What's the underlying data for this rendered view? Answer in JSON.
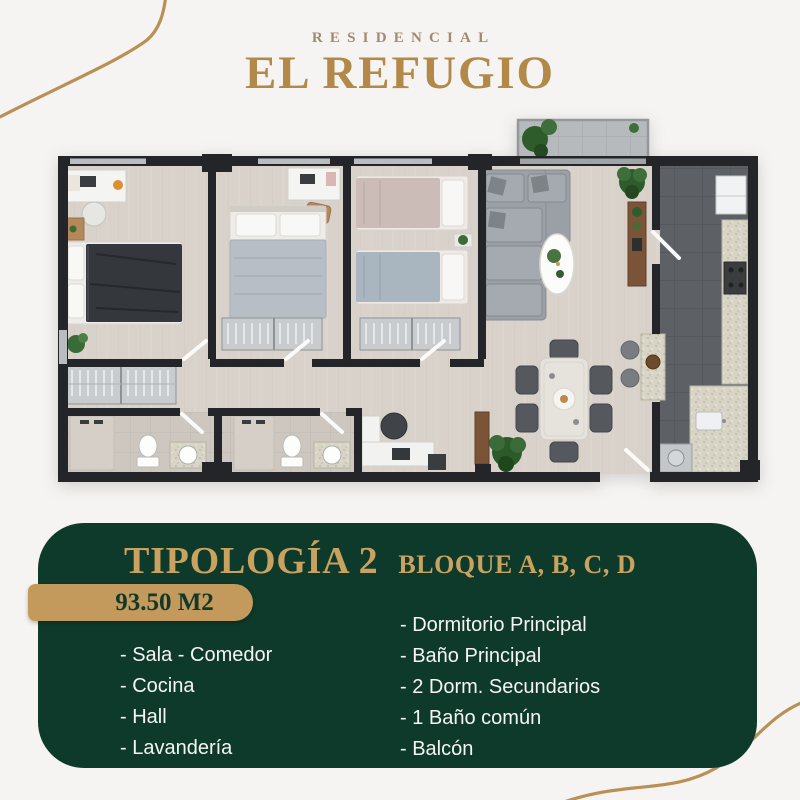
{
  "page": {
    "background": "#f5f4f2",
    "decor_line_color": "#b99055"
  },
  "logo": {
    "subtitle": "RESIDENCIAL",
    "title": "EL REFUGIO",
    "subtitle_color": "#a18b6e",
    "title_color": "#b3894a"
  },
  "floor_plan": {
    "wall_color": "#232528",
    "wood_floor_color": "#d9d2ca",
    "kitchen_tile_color": "#5d6165",
    "bathroom_tile_color": "#cdc7c0",
    "balcony_tile_color": "#b6babc",
    "sofa_color": "#9aa0a5",
    "plant_color": "#2e5c2b",
    "wood_accent_color": "#b5885c"
  },
  "card": {
    "background": "#0e3a2b",
    "title": "TIPOLOGÍA 2",
    "subtitle": "BLOQUE A, B, C, D",
    "title_color": "#c9a25f",
    "area_badge": {
      "text": "93.50 M2",
      "background": "#c49a5c",
      "text_color": "#11392a"
    },
    "features_left": [
      "- Sala - Comedor",
      "- Cocina",
      "- Hall",
      "- Lavandería"
    ],
    "features_right": [
      "- Dormitorio Principal",
      "- Baño Principal",
      "- 2 Dorm. Secundarios",
      "- 1 Baño común",
      "- Balcón"
    ],
    "text_color": "#f6f5f2"
  }
}
